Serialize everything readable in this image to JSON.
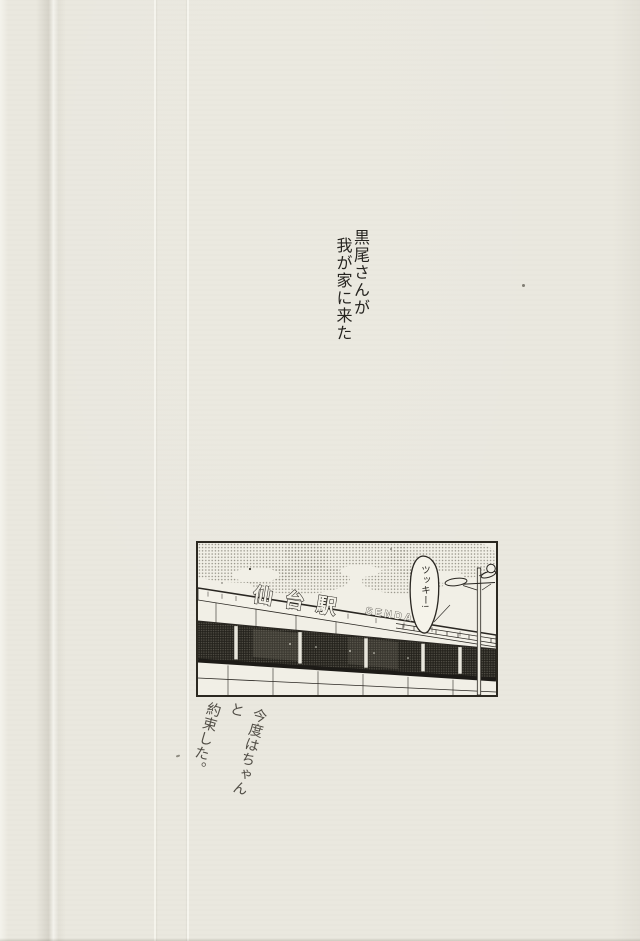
{
  "page": {
    "paper_color": "#eae8df",
    "ink_color": "#2a2722"
  },
  "narration": {
    "lines": [
      "黒尾さんが",
      "我が家に来た"
    ]
  },
  "panel": {
    "station_sign_kanji": "仙台駅",
    "station_sign_romaji": "SENDAI",
    "speech_bubble_text": "ツッキー!"
  },
  "caption": {
    "lines": [
      "今度はちゃんと",
      "約束した。"
    ]
  }
}
